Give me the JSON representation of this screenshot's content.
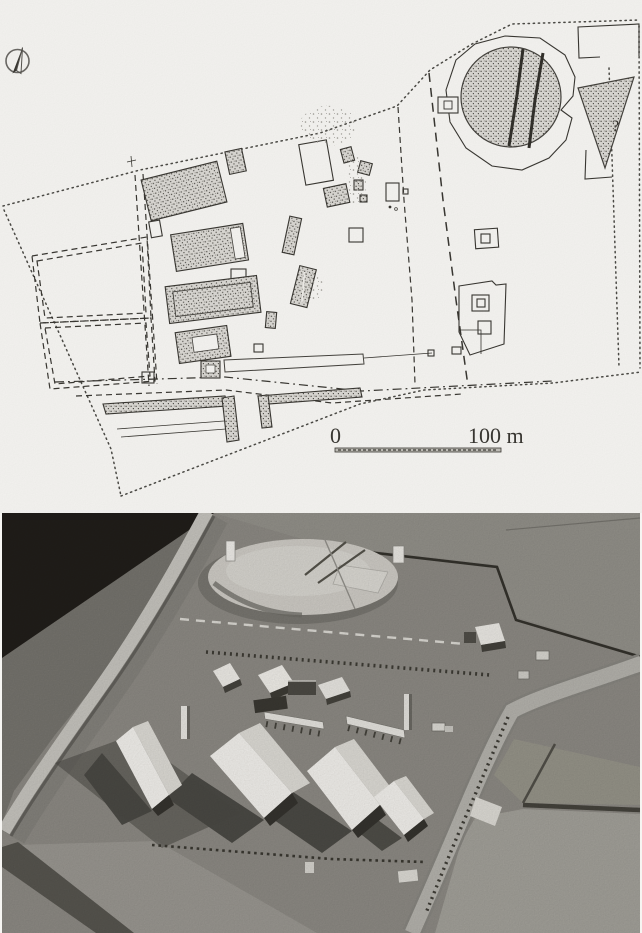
{
  "figure": {
    "description": "Scanned two-part archaeological figure: excavation site plan (top) and photograph of a physical reconstruction model of the same settlement (bottom)",
    "panels": [
      {
        "id": "site-plan",
        "kind": "plan-drawing"
      },
      {
        "id": "model-photo",
        "kind": "photograph-of-model"
      }
    ]
  },
  "plan": {
    "north_arrow": "north-arrow-roundel",
    "scale_bar": {
      "zero_label": "0",
      "end_label": "100 m"
    },
    "uncertainty_mark": "?",
    "features": [
      "dotted site boundary",
      "stippled excavated buildings",
      "double-dashed field enclosures",
      "large stippled burial mound with two slash lines",
      "stippled triangular feature marked ?",
      "trackway and road alignments",
      "scale bar 0 to 100 m"
    ]
  },
  "photo": {
    "features": [
      "dark backdrop top left",
      "curved modern road",
      "circular burial mound with cut wedge",
      "dashed excavation limit",
      "palisade post rows",
      "white gabled longhouses with cast shadows",
      "diagonal road with field parcels lower right"
    ]
  },
  "colors": {
    "paper": "#f6f5f2",
    "ink": "#3a3833",
    "stipple-bg": "#dbd9d4",
    "stipple-dot": "#45433e",
    "photo-terrain": "#8d8a84",
    "photo-backdrop": "#211e1a",
    "photo-road": "#c7c5bf",
    "photo-mound": "#cfccc6",
    "photo-roof": "#f3f1ed",
    "photo-shadow": "#403e39"
  }
}
